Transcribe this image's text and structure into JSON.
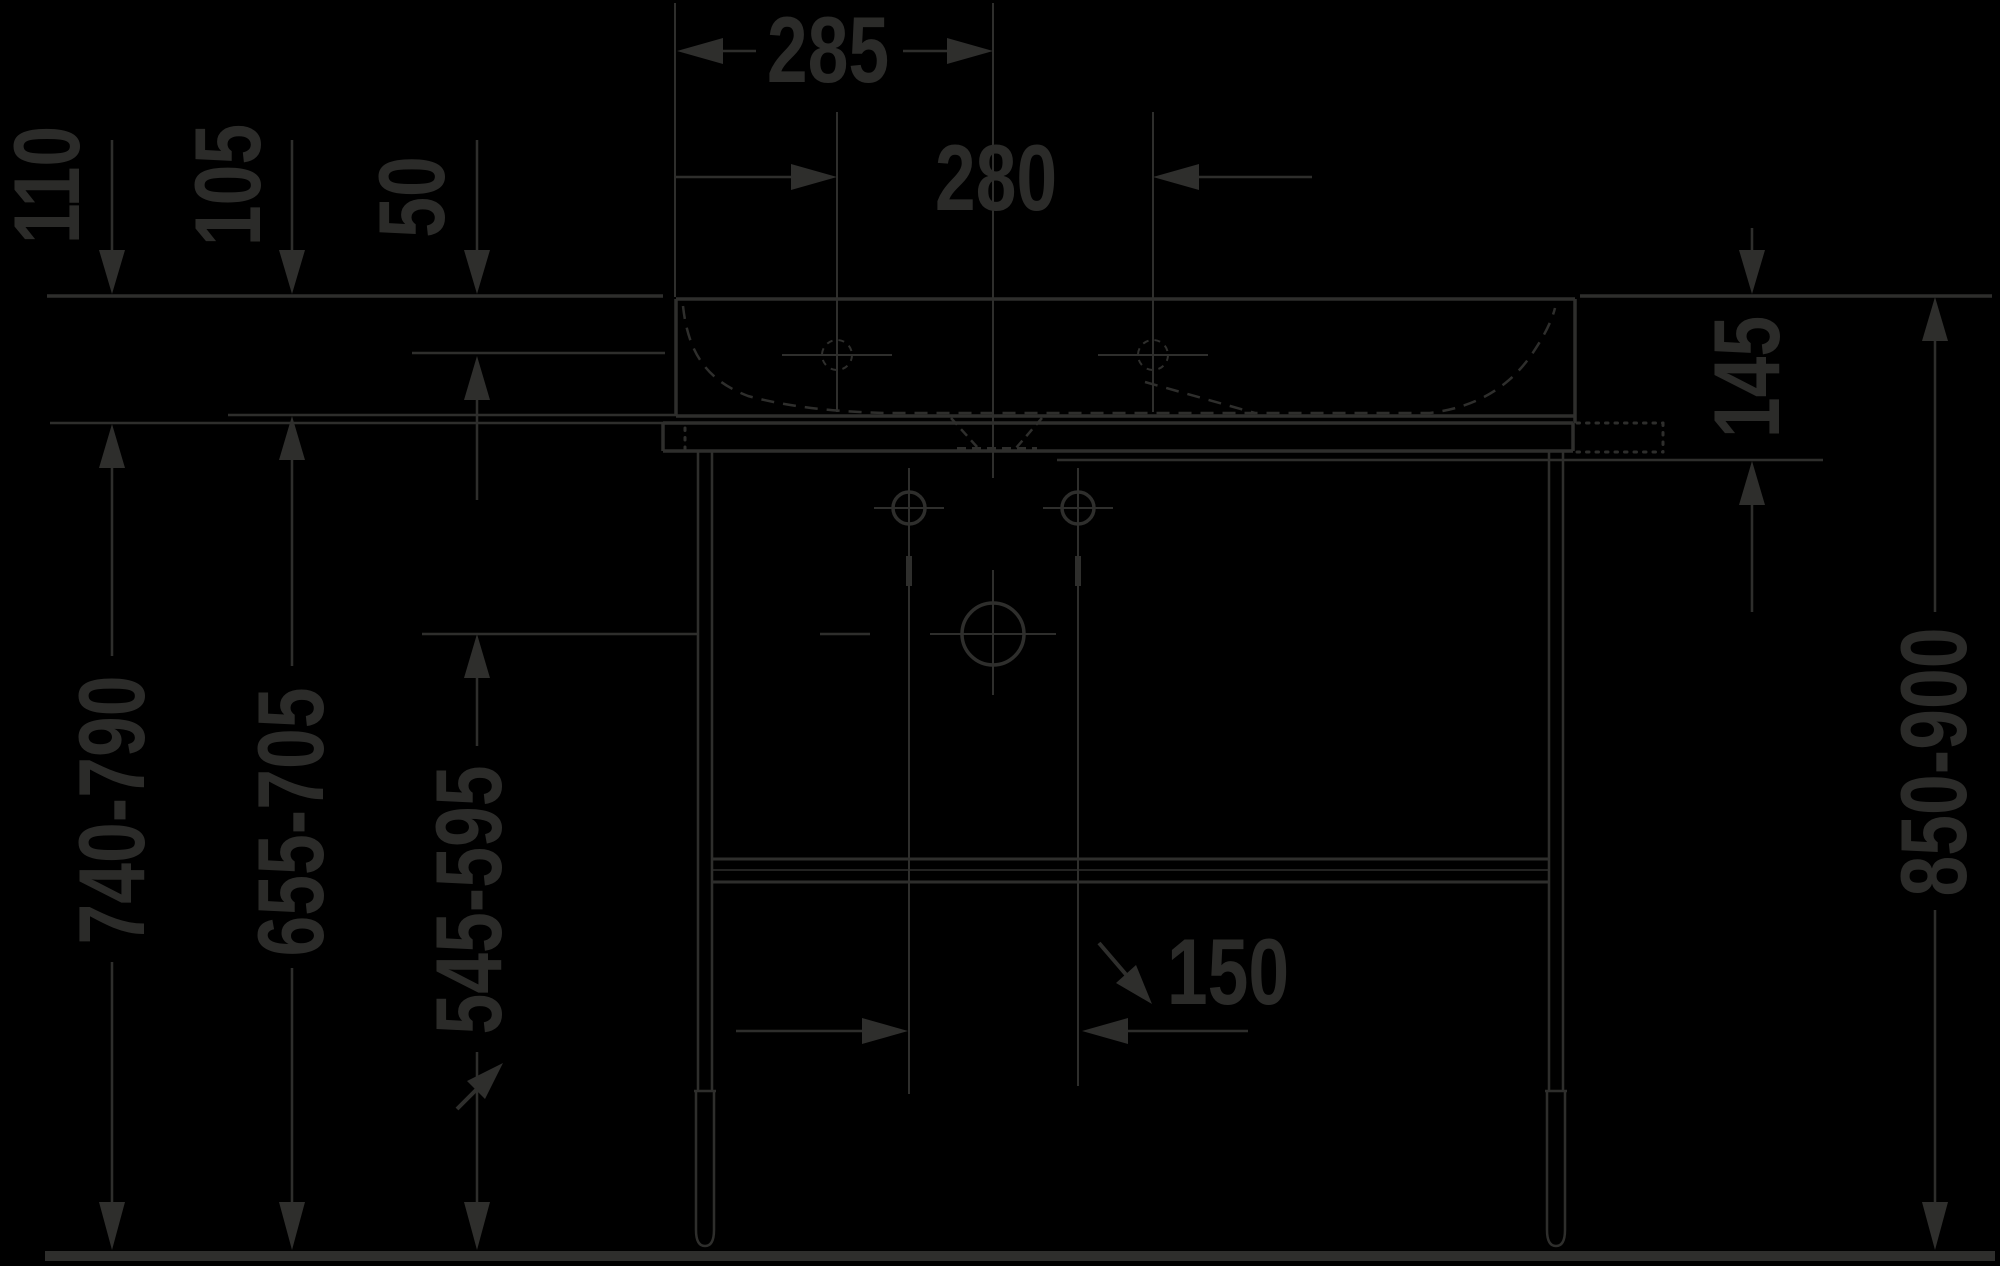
{
  "diagram": {
    "type": "technical-dimension-drawing",
    "subject": "washbasin with metal console legs - front section view",
    "units": "mm",
    "colors": {
      "background": "#000000",
      "stroke": "#2e2e2c",
      "text": "#2b2b29"
    },
    "labels": {
      "width_left_edge_to_drain": "285",
      "faucet_hole_spacing": "280",
      "rim_to_console_plate": "110",
      "rim_to_basin_underside": "105",
      "rim_to_deck_step": "50",
      "basin_front_height": "145",
      "floor_to_console_plate": "740-790",
      "floor_to_basin_underside": "655-705",
      "floor_to_drain_center": "545-595",
      "floor_to_rim": "850-900",
      "mounting_hole_spacing": "150"
    }
  }
}
